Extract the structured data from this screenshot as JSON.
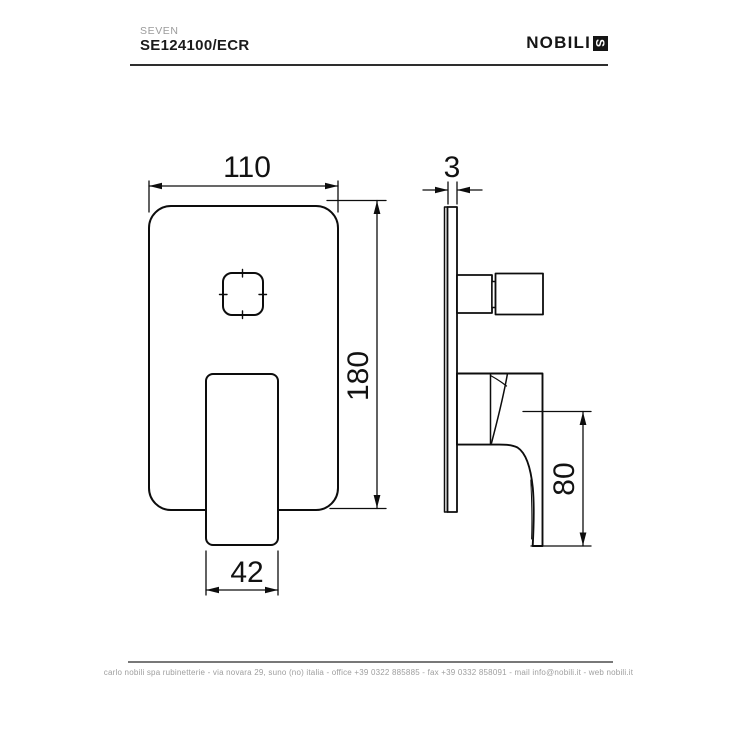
{
  "header": {
    "series": "SEVEN",
    "code": "SE124100/ECR",
    "brand": "NOBILI",
    "brand_mark": "S"
  },
  "drawing": {
    "front_view": {
      "plate_width_mm": "110",
      "plate_height_mm": "180",
      "handle_width_mm": "42"
    },
    "side_view": {
      "plate_thickness_mm": "3",
      "lever_height_mm": "80"
    }
  },
  "footer": {
    "contact_line": "carlo nobili spa rubinetterie - via novara 29, suno (no) italia - office +39 0322 885885 - fax +39 0332 858091 - mail info@nobili.it - web nobili.it"
  },
  "colors": {
    "line": "#000000",
    "muted": "#9e9e9e"
  }
}
